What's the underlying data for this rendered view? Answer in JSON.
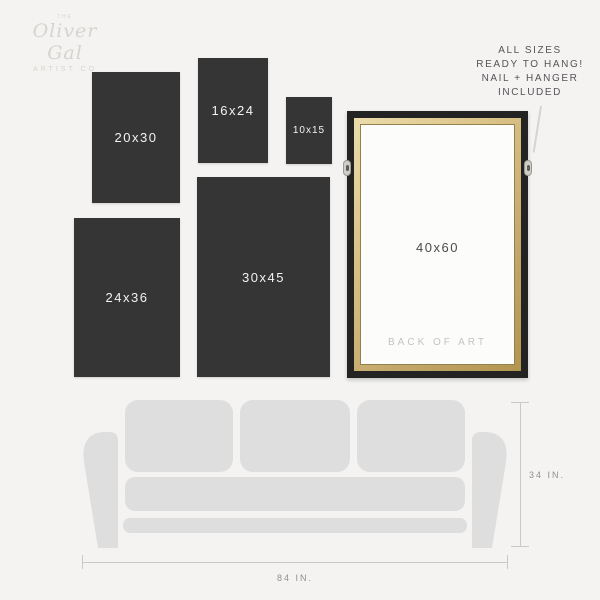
{
  "brand": {
    "the": "THE",
    "name": "Oliver Gal",
    "subtitle": "ARTIST CO"
  },
  "sizes": [
    {
      "label": "20x30"
    },
    {
      "label": "16x24"
    },
    {
      "label": "10x15"
    },
    {
      "label": "24x36"
    },
    {
      "label": "30x45"
    }
  ],
  "framed_canvas": {
    "size_label": "40x60",
    "back_label": "BACK OF ART"
  },
  "callout": {
    "lines": [
      "ALL SIZES",
      "READY TO HANG!",
      "NAIL + HANGER",
      "INCLUDED"
    ]
  },
  "dimensions": {
    "sofa_height": "34 IN.",
    "sofa_width": "84 IN."
  },
  "colors": {
    "background": "#f4f3f1",
    "panel_dark": "#353535",
    "panel_text": "#f2f2f2",
    "sofa": "#dedede",
    "frame_black": "#232323",
    "frame_gold": "#cdb279",
    "canvas_white": "#fcfcfb",
    "dimension_line": "#c9c9c6",
    "dimension_text": "#909090",
    "callout_text": "#54555a",
    "back_label_text": "#c3c3c1",
    "logo_text": "#d5d4d0"
  }
}
